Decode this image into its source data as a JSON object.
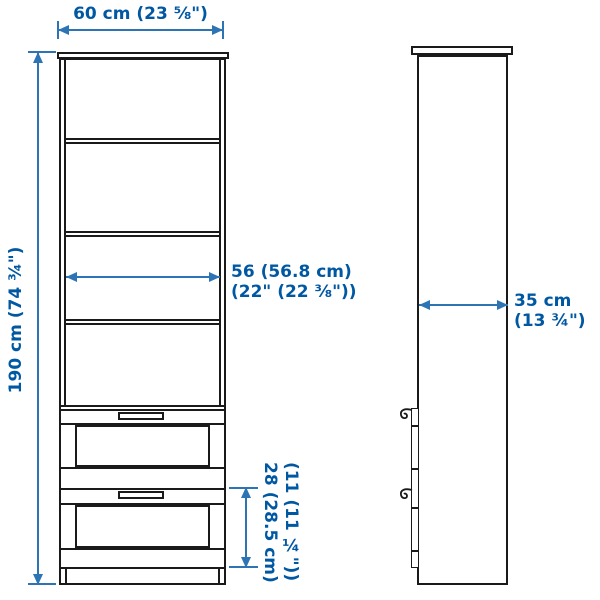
{
  "diagram": {
    "type": "furniture-dimension-drawing",
    "views": [
      "front",
      "side"
    ],
    "labels": {
      "width": "60 cm (23 ⅝\")",
      "height": "190 cm (74 ¾\")",
      "inner_width_cm": "56 (56.8 cm)",
      "inner_width_in": "(22\" (22 ⅜\"))",
      "depth_cm": "35 cm",
      "depth_in": "(13 ¾\")",
      "drawer_cm": "28 (28.5 cm)",
      "drawer_in": "(11 (11 ¼\"))"
    },
    "colors": {
      "dimension_text": "#0058a3",
      "dimension_line": "#2d74b5",
      "outline": "#1a1a1a",
      "background": "#ffffff"
    }
  }
}
